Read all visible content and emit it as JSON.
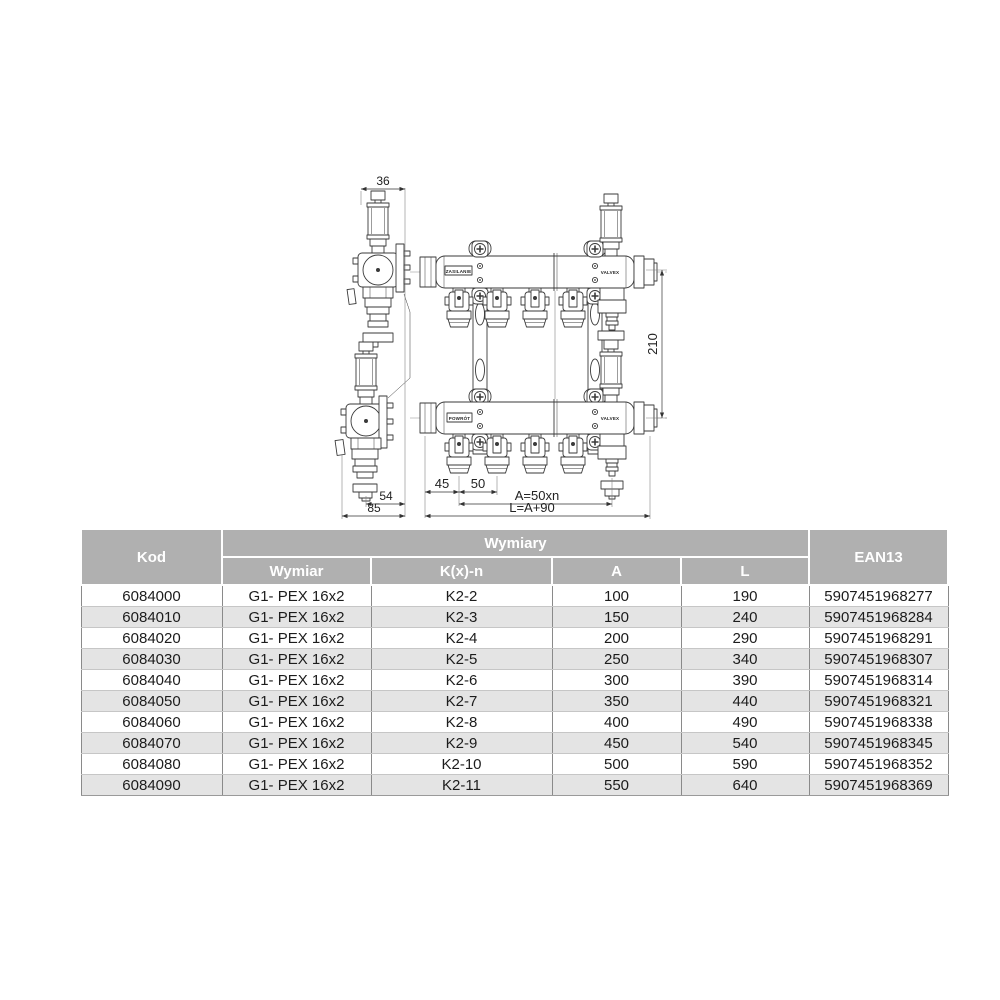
{
  "drawing": {
    "dimensions": {
      "top_width": "36",
      "side_offset": "54",
      "side_depth": "85",
      "first_outlet_offset": "45",
      "outlet_spacing": "50",
      "length_a_formula": "A=50xn",
      "length_l_formula": "L=A+90",
      "axis_distance": "210"
    },
    "labels": {
      "supply": "ZASILANIE",
      "return": "POWRÓT",
      "brand_upper": "VALVEX",
      "brand_lower": "VALVEX"
    }
  },
  "table": {
    "header": {
      "kod": "Kod",
      "wymiary_group": "Wymiary",
      "wymiar": "Wymiar",
      "kxn": "K(x)-n",
      "a": "A",
      "l": "L",
      "ean13": "EAN13"
    },
    "rows": [
      {
        "kod": "6084000",
        "wymiar": "G1- PEX 16x2",
        "kxn": "K2-2",
        "a": "100",
        "l": "190",
        "ean": "5907451968277"
      },
      {
        "kod": "6084010",
        "wymiar": "G1- PEX 16x2",
        "kxn": "K2-3",
        "a": "150",
        "l": "240",
        "ean": "5907451968284"
      },
      {
        "kod": "6084020",
        "wymiar": "G1- PEX 16x2",
        "kxn": "K2-4",
        "a": "200",
        "l": "290",
        "ean": "5907451968291"
      },
      {
        "kod": "6084030",
        "wymiar": "G1- PEX 16x2",
        "kxn": "K2-5",
        "a": "250",
        "l": "340",
        "ean": "5907451968307"
      },
      {
        "kod": "6084040",
        "wymiar": "G1- PEX 16x2",
        "kxn": "K2-6",
        "a": "300",
        "l": "390",
        "ean": "5907451968314"
      },
      {
        "kod": "6084050",
        "wymiar": "G1- PEX 16x2",
        "kxn": "K2-7",
        "a": "350",
        "l": "440",
        "ean": "5907451968321"
      },
      {
        "kod": "6084060",
        "wymiar": "G1- PEX 16x2",
        "kxn": "K2-8",
        "a": "400",
        "l": "490",
        "ean": "5907451968338"
      },
      {
        "kod": "6084070",
        "wymiar": "G1- PEX 16x2",
        "kxn": "K2-9",
        "a": "450",
        "l": "540",
        "ean": "5907451968345"
      },
      {
        "kod": "6084080",
        "wymiar": "G1- PEX 16x2",
        "kxn": "K2-10",
        "a": "500",
        "l": "590",
        "ean": "5907451968352"
      },
      {
        "kod": "6084090",
        "wymiar": "G1- PEX 16x2",
        "kxn": "K2-11",
        "a": "550",
        "l": "640",
        "ean": "5907451968369"
      }
    ],
    "colors": {
      "header_bg": "#b0b0b0",
      "header_text": "#ffffff",
      "row_alt_bg": "#e4e4e4",
      "grid_line": "#8a8a8a",
      "text": "#1c1c1c"
    }
  }
}
